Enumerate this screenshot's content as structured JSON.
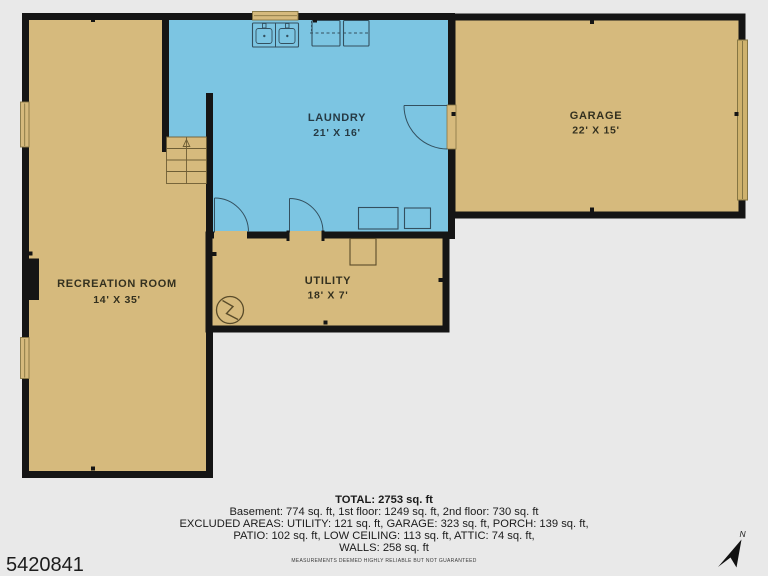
{
  "palette": {
    "background": "#e9e9e9",
    "wall": "#151515",
    "room_fill_tan": "#d6ba7d",
    "room_fill_blue": "#7cc5e2",
    "window_trim": "#857543",
    "fixture_stroke_blue_room": "#33505f",
    "fixture_stroke_tan_room": "#5a4c2a"
  },
  "plan": {
    "rooms": [
      {
        "name": "GARAGE",
        "dims": "22' X 15'"
      },
      {
        "name": "LAUNDRY",
        "dims": "21' X 16'"
      },
      {
        "name": "UTILITY",
        "dims": "18' X 7'"
      },
      {
        "name": "RECREATION ROOM",
        "dims": "14' X 35'"
      }
    ]
  },
  "summary": {
    "total": "TOTAL: 2753 sq. ft",
    "floors": "Basement: 774 sq. ft, 1st floor: 1249 sq. ft, 2nd floor: 730 sq. ft",
    "excluded_1": "EXCLUDED AREAS: UTILITY: 121 sq. ft, GARAGE: 323 sq. ft, PORCH: 139 sq. ft,",
    "excluded_2": "PATIO: 102 sq. ft, LOW CEILING: 113 sq. ft, ATTIC: 74 sq. ft,",
    "excluded_3": "WALLS: 258 sq. ft",
    "disclaimer": "MEASUREMENTS DEEMED HIGHLY RELIABLE BUT NOT GUARANTEED"
  },
  "listing_id": "5420841",
  "compass": {
    "label": "N"
  }
}
